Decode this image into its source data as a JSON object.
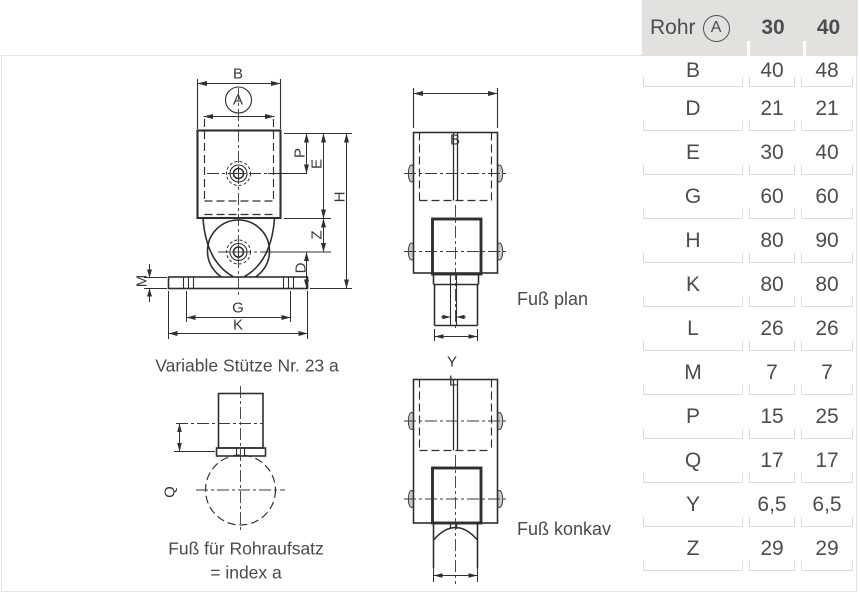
{
  "captions": {
    "main_view": "Variable Stütze Nr. 23 a",
    "foot_plan": "Fuß plan",
    "foot_concave": "Fuß konkav",
    "foot_tube_line1": "Fuß für Rohraufsatz",
    "foot_tube_line2": "= index a"
  },
  "dim_letters": {
    "B": "B",
    "A": "A",
    "P": "P",
    "E": "E",
    "H": "H",
    "Z": "Z",
    "D": "D",
    "M": "M",
    "G": "G",
    "K": "K",
    "Y": "Y",
    "L": "L",
    "Q": "Q"
  },
  "table": {
    "header": {
      "rohr": "Rohr",
      "tube_symbol": "A",
      "col_30": "30",
      "col_40": "40"
    },
    "rows": [
      {
        "label": "B",
        "v30": "40",
        "v40": "48"
      },
      {
        "label": "D",
        "v30": "21",
        "v40": "21"
      },
      {
        "label": "E",
        "v30": "30",
        "v40": "40"
      },
      {
        "label": "G",
        "v30": "60",
        "v40": "60"
      },
      {
        "label": "H",
        "v30": "80",
        "v40": "90"
      },
      {
        "label": "K",
        "v30": "80",
        "v40": "80"
      },
      {
        "label": "L",
        "v30": "26",
        "v40": "26"
      },
      {
        "label": "M",
        "v30": "7",
        "v40": "7"
      },
      {
        "label": "P",
        "v30": "15",
        "v40": "25"
      },
      {
        "label": "Q",
        "v30": "17",
        "v40": "17"
      },
      {
        "label": "Y",
        "v30": "6,5",
        "v40": "6,5"
      },
      {
        "label": "Z",
        "v30": "29",
        "v40": "29"
      }
    ]
  },
  "colors": {
    "line": "#2f2f2f",
    "header_bg": "#e2e1de",
    "cell_border": "#dcdcdc",
    "page_border": "#e4e4e4",
    "text": "#4a4a4a"
  }
}
